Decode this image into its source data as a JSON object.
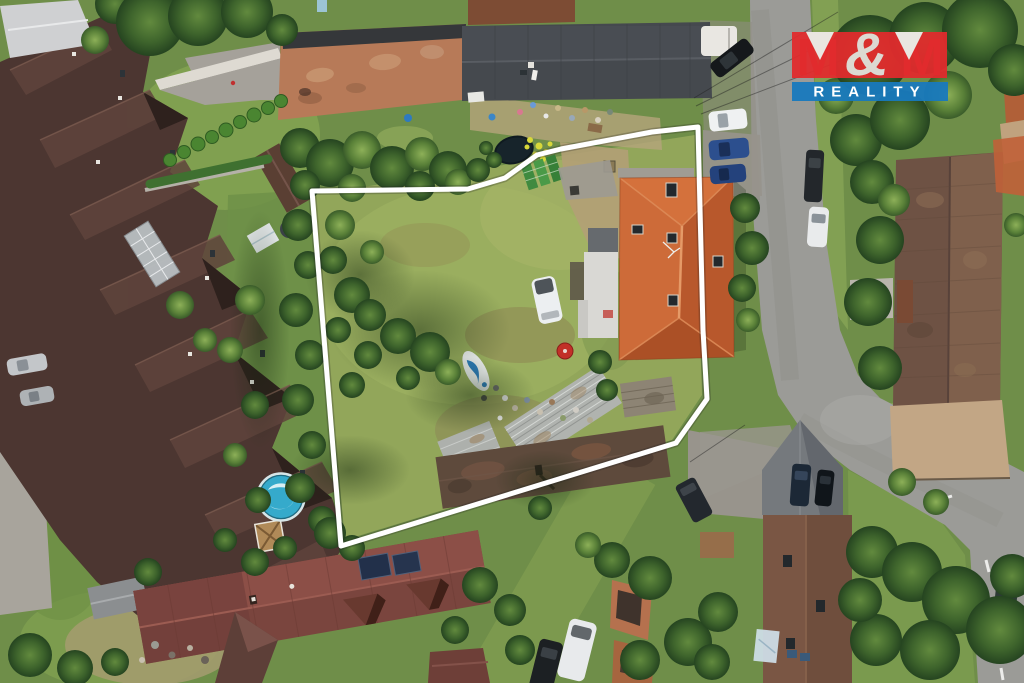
{
  "logo": {
    "m_left": "M",
    "ampersand": "&",
    "m_right": "M",
    "wordmark": "REALITY",
    "colors": {
      "red": "#e12b2d",
      "blue": "#1879bd",
      "accent_text": "#dcd9d2",
      "wordmark_text": "#ffffff"
    }
  },
  "overlay": {
    "boundary_color": "#ffffff"
  },
  "scene": {
    "kind": "aerial-drone-photo-of-property",
    "colors": {
      "lawn": "#92a65a",
      "road": "#9b9b97",
      "orange_roof": "#c5602f",
      "rowhouse_roof": "#4c3631",
      "barn_roof": "#b77a58",
      "dark_roof": "#45494e",
      "red_roof": "#8c4a42",
      "pool_water": "#35aacb"
    }
  }
}
